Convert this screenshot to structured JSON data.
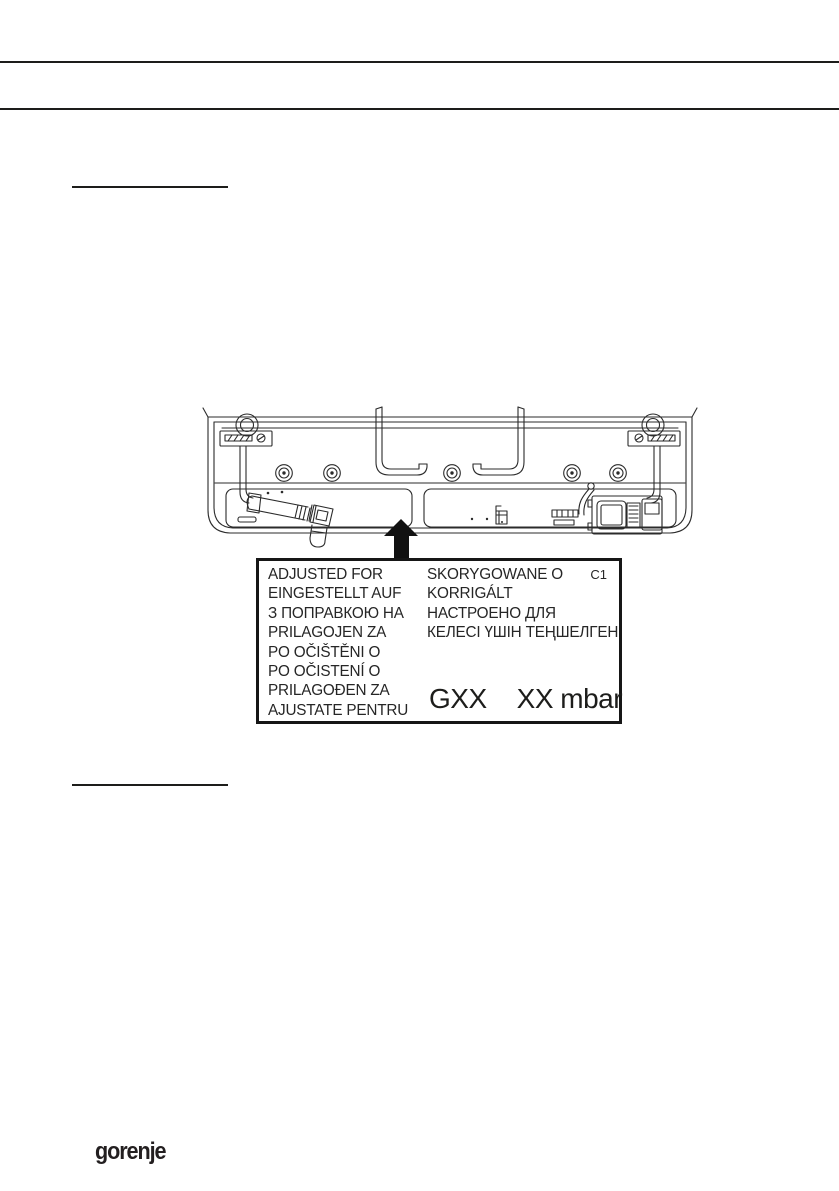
{
  "label_plate": {
    "code": "C1",
    "left_lines": [
      "ADJUSTED FOR",
      "EINGESTELLT AUF",
      "З ПОПРАВКОЮ НА",
      "PRILAGOJEN ZA",
      "PO OČIŠTĚNI O",
      "PO OČISTENÍ O",
      "PRILAGOĐEN ZA",
      "AJUSTATE PENTRU"
    ],
    "right_lines": [
      "SKORYGOWANE O",
      "KORRIGÁLT",
      "НАСТРОЕНО ДЛЯ",
      "КЕЛЕСІ ҮШІН ТЕҢШЕЛГЕН"
    ],
    "gas_type": "GXX",
    "gas_pressure": "XX mbar"
  },
  "icons": {
    "label_pointer": "up-arrow"
  },
  "colors": {
    "ink": "#1d1d1b",
    "label_text": "#262626"
  },
  "footer": {
    "brand_logo_text": "gorenje"
  }
}
